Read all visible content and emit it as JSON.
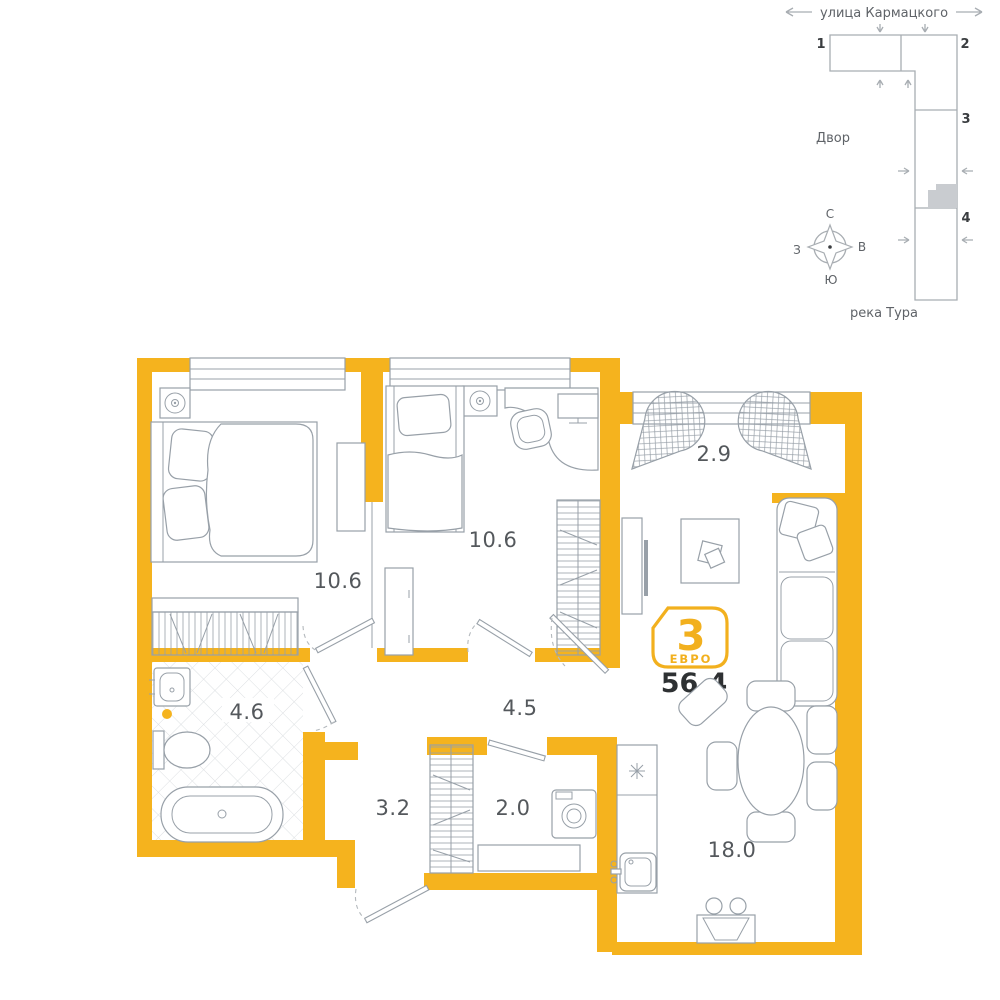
{
  "colors": {
    "wall": "#F5B31E",
    "accent": "#F2B01E",
    "furniture_line": "#98A0A8",
    "room_label": "#54585C",
    "dark_text": "#2E3133",
    "minimap_line": "#A8ADB2",
    "highlighted_unit_fill": "#C9CCD0"
  },
  "unit_badge": {
    "rooms_count": "3",
    "type_label": "ЕВРО",
    "total_area": "56.4"
  },
  "rooms": [
    {
      "name": "bedroom-1",
      "area": "10.6"
    },
    {
      "name": "bedroom-2",
      "area": "10.6"
    },
    {
      "name": "balcony",
      "area": "2.9"
    },
    {
      "name": "hallway",
      "area": "4.5"
    },
    {
      "name": "bathroom",
      "area": "4.6"
    },
    {
      "name": "entry-hall",
      "area": "3.2"
    },
    {
      "name": "wardrobe-room",
      "area": "2.0"
    },
    {
      "name": "kitchen-living",
      "area": "18.0"
    }
  ],
  "minimap": {
    "street": "улица Кармацкого",
    "courtyard": "Двор",
    "river": "река Тура",
    "sections": [
      "1",
      "2",
      "3",
      "4"
    ],
    "compass": {
      "north": "С",
      "east": "В",
      "south": "Ю",
      "west": "З"
    }
  }
}
